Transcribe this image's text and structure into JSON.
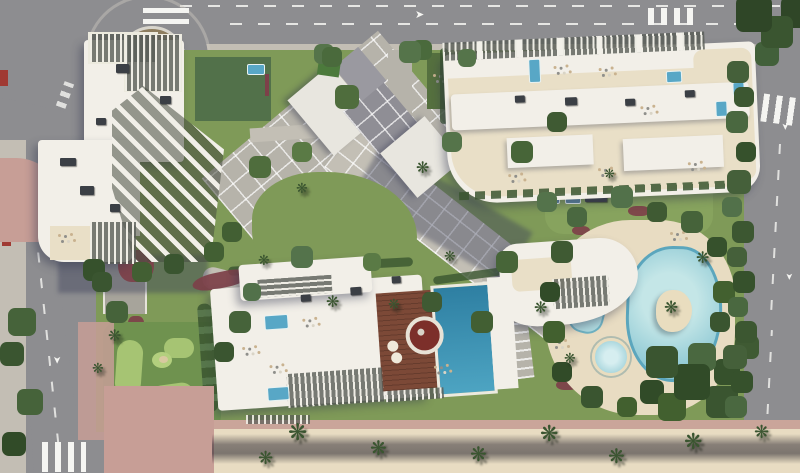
{
  "scene": {
    "description": "Aerial architectural rendering of a beachfront residential complex: three white apartment buildings with sculptural balcony fins and rooftop pergolas, landscaped gardens with palm trees and red flower beds, a free-form lagoon pool with sand island and jacuzzi, a rooftop lap pool on a timber deck, mini-golf putting greens, perimeter roads with a roundabout, zebra crossings, lane arrows and a palm-lined sandy beach promenade."
  },
  "icons": {
    "palm": "❋",
    "arrow": "➤"
  },
  "palette": {
    "building_white": "#f2efe8",
    "terrace_beige": "#e9dfc7",
    "road_asphalt": "#8d8d90",
    "road_dark": "#77777b",
    "sidewalk": "#c3beb4",
    "pink_paving": "#c79e96",
    "lawn": "#7f9a58",
    "lawn_bright": "#a6c473",
    "tree_dark": "#3a5530",
    "tree_mid": "#52714a",
    "flower_red": "#7d4049",
    "sand": "#e8dcc2",
    "lagoon_water": "#9fd2da",
    "lagoon_edge": "#5ba6bd",
    "rooftop_pool": "#2e7fa2",
    "plunge_pool": "#58a7c6",
    "deck_wood": "#7c4937",
    "path_light": "#c3bfb5",
    "plaza_gray": "#b6b3aa",
    "island_sand": "#e9ddbf",
    "roundabout_soil": "#8d7d5e",
    "shadow": "rgba(58,62,88,0.42)",
    "marking_white": "#f5f5f2"
  }
}
